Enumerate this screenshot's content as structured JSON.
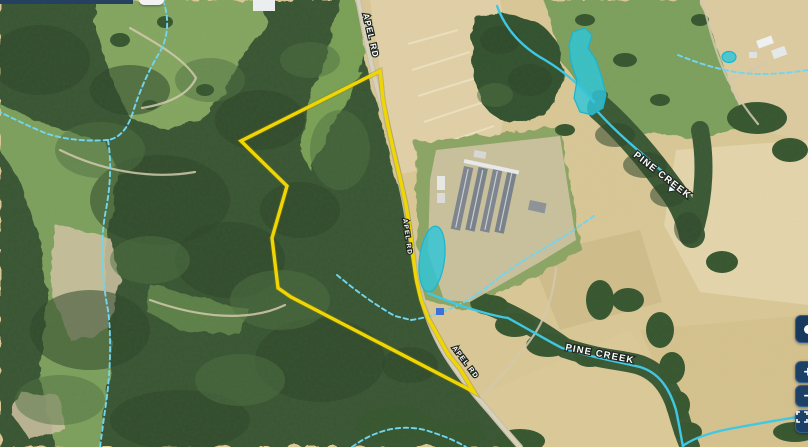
{
  "map": {
    "road_labels": [
      {
        "name": "apel-rd-top",
        "text": "APEL RD"
      },
      {
        "name": "apel-rd-middle",
        "text": "APEL RD"
      },
      {
        "name": "apel-rd-lower",
        "text": "APEL RD"
      }
    ],
    "creek_labels": [
      {
        "name": "pine-creek-upper",
        "text": "PINE CREEK"
      },
      {
        "name": "pine-creek-lower",
        "text": "PINE CREEK"
      }
    ],
    "overlay_colors": {
      "property_boundary": "#f2d600",
      "stream_solid": "#3cc8e6",
      "stream_intermittent": "#6fd6f2",
      "pond_fill": "#2cc6db",
      "label_text": "#ffffff",
      "control_button": "#1d4067"
    }
  },
  "controls": {
    "buttons": [
      {
        "name": "locate",
        "icon": "locate-icon",
        "glyph": "●"
      },
      {
        "name": "zoom-in",
        "icon": "plus-icon",
        "glyph": "+"
      },
      {
        "name": "zoom-out",
        "icon": "minus-icon",
        "glyph": "−"
      },
      {
        "name": "fullscreen",
        "icon": "fullscreen-icon",
        "glyph": "⛶"
      }
    ]
  }
}
